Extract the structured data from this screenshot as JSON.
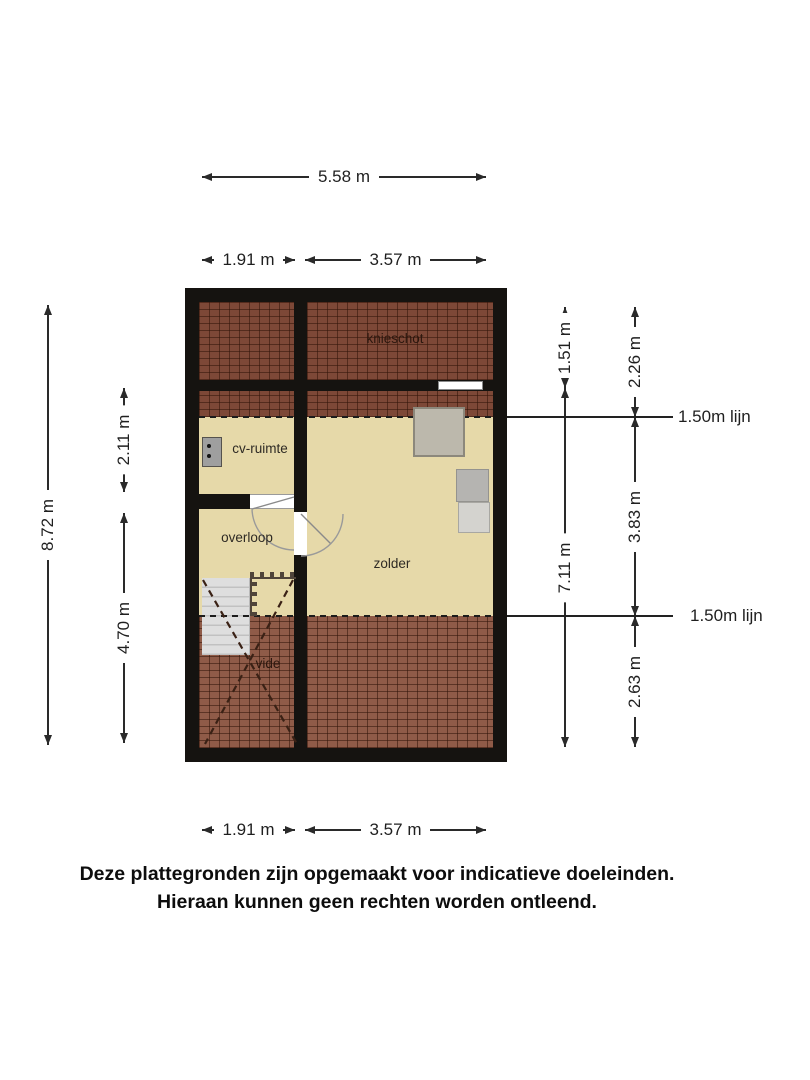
{
  "colors": {
    "wall": "#151310",
    "floor": "#e6d9a9",
    "tile_dark": "#7d4837",
    "tile_light": "#8f5b48",
    "tile_line": "rgba(48,19,8,0.55)",
    "stairs": "#dedede",
    "dim": "#2a2a2a",
    "object_gray": "#bcb8ac"
  },
  "rooms": {
    "knieschot": "knieschot",
    "cv_ruimte": "cv-ruimte",
    "overloop": "overloop",
    "zolder": "zolder",
    "vide": "vide"
  },
  "dims": {
    "top_total": "5.58 m",
    "top_left": "1.91 m",
    "top_right": "3.57 m",
    "bottom_left": "1.91 m",
    "bottom_right": "3.57 m",
    "left_total": "8.72 m",
    "left_upper": "2.11 m",
    "left_lower": "4.70 m",
    "right_inner_top": "1.51 m",
    "right_inner_bottom": "7.11 m",
    "right_outer_top": "2.26 m",
    "right_outer_middle": "3.83 m",
    "right_outer_bottom": "2.63 m"
  },
  "reflines": {
    "upper": "1.50m lijn",
    "lower": "1.50m lijn"
  },
  "disclaimer": {
    "line1": "Deze plattegronden zijn opgemaakt voor indicatieve doeleinden.",
    "line2": "Hieraan kunnen geen rechten worden ontleend."
  }
}
